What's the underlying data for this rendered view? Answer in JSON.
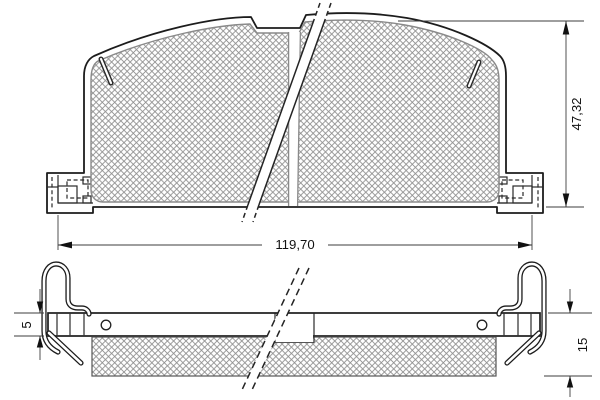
{
  "dims": {
    "overall_width": "119,70",
    "overall_height": "47,32",
    "plate_thickness": "5",
    "total_thickness": "15"
  },
  "colors": {
    "line": "#1c1c1c",
    "hatch": "#8f8f8f",
    "dimension": "#111111",
    "background": "#ffffff"
  }
}
